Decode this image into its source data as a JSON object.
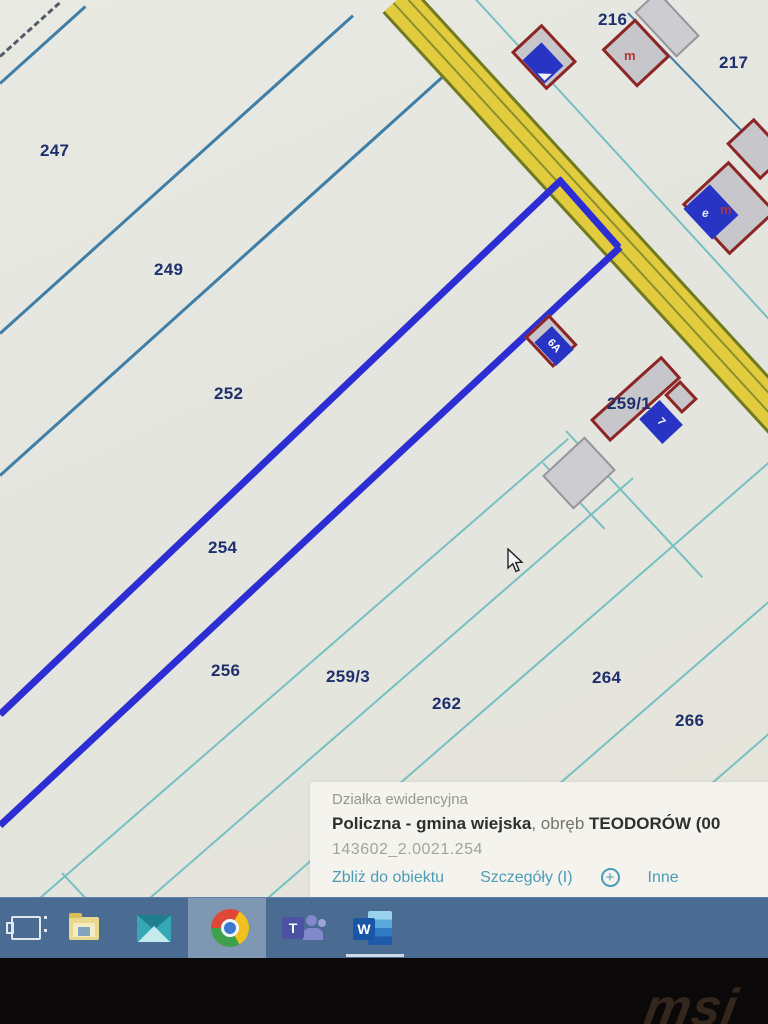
{
  "map": {
    "parcel_labels": [
      {
        "id": "247"
      },
      {
        "id": "249"
      },
      {
        "id": "252"
      },
      {
        "id": "254"
      },
      {
        "id": "256"
      },
      {
        "id": "259/3"
      },
      {
        "id": "262"
      },
      {
        "id": "264"
      },
      {
        "id": "266"
      },
      {
        "id": "216"
      },
      {
        "id": "217"
      },
      {
        "id": "259/1"
      }
    ],
    "building_tags": {
      "m_top": "m",
      "e_mid": "e",
      "m_mid": "m",
      "house_6a": "6A",
      "house_7": "7"
    }
  },
  "info_panel": {
    "title": "Działka ewidencyjna",
    "name_bold": "Policzna - gmina wiejska",
    "name_mid": ", obręb ",
    "name_tail": "TEODORÓW (00",
    "parcel_id": "143602_2.0021.254",
    "links": {
      "zoom_to": "Zbliż do obiektu",
      "details": "Szczegóły (I)",
      "plus": "+",
      "more": "Inne"
    }
  },
  "taskbar": {
    "teams_letter": "T",
    "word_letter": "W"
  },
  "bezel": {
    "logo": "msi"
  }
}
